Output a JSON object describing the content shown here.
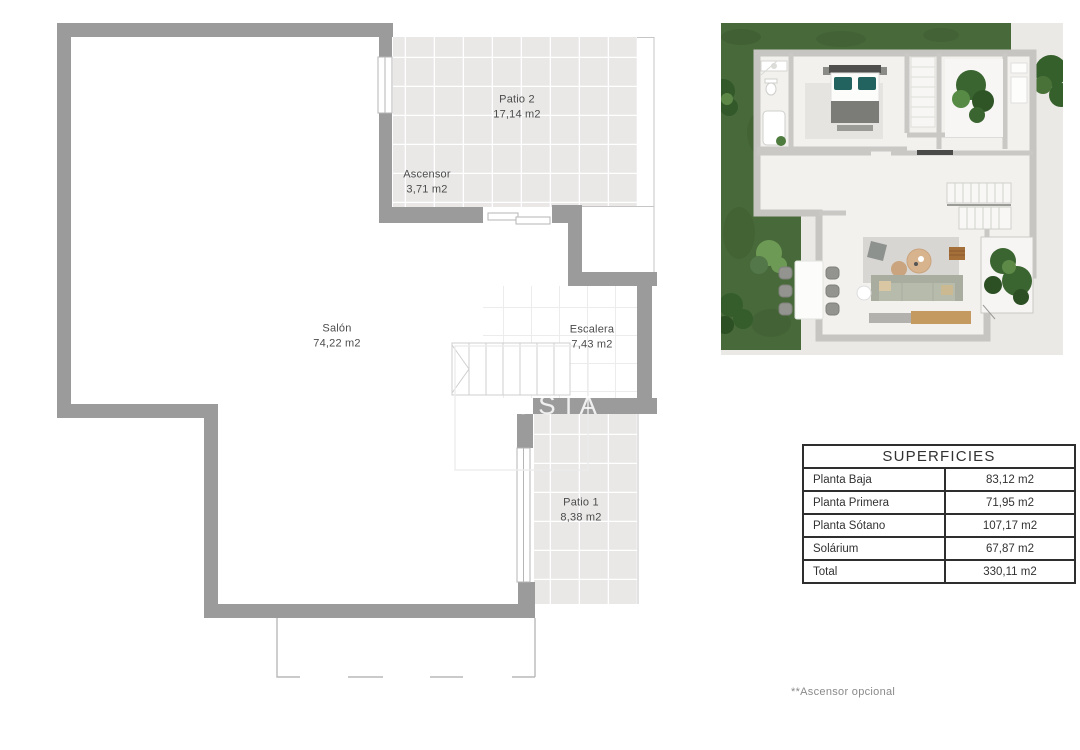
{
  "floor_plan": {
    "rooms": [
      {
        "name": "Patio 2",
        "area": "17,14 m2"
      },
      {
        "name": "Ascensor",
        "area": "3,71 m2"
      },
      {
        "name": "Salón",
        "area": "74,22 m2"
      },
      {
        "name": "Escalera",
        "area": "7,43 m2"
      },
      {
        "name": "Patio 1",
        "area": "8,38 m2"
      }
    ],
    "watermark": "OSTA"
  },
  "table": {
    "title": "SUPERFICIES",
    "rows": [
      {
        "label": "Planta Baja",
        "value": "83,12 m2"
      },
      {
        "label": "Planta Primera",
        "value": "71,95 m2"
      },
      {
        "label": "Planta Sótano",
        "value": "107,17 m2"
      },
      {
        "label": "Solárium",
        "value": "67,87 m2"
      },
      {
        "label": "Total",
        "value": "330,11 m2"
      }
    ]
  },
  "footnote": "**Ascensor opcional",
  "colors": {
    "wall_gray": "#9b9b9b",
    "tile_fill": "#e9e8e7",
    "thin_line": "#c6c6c6",
    "label_text": "#4c4c4c",
    "table_border": "#2e2e2e",
    "grass_green": "#486a3a",
    "paving": "#ebe9e6",
    "house_wall": "#c6c5c2",
    "pillow_teal": "#23635f",
    "wood": "#c59a61"
  }
}
